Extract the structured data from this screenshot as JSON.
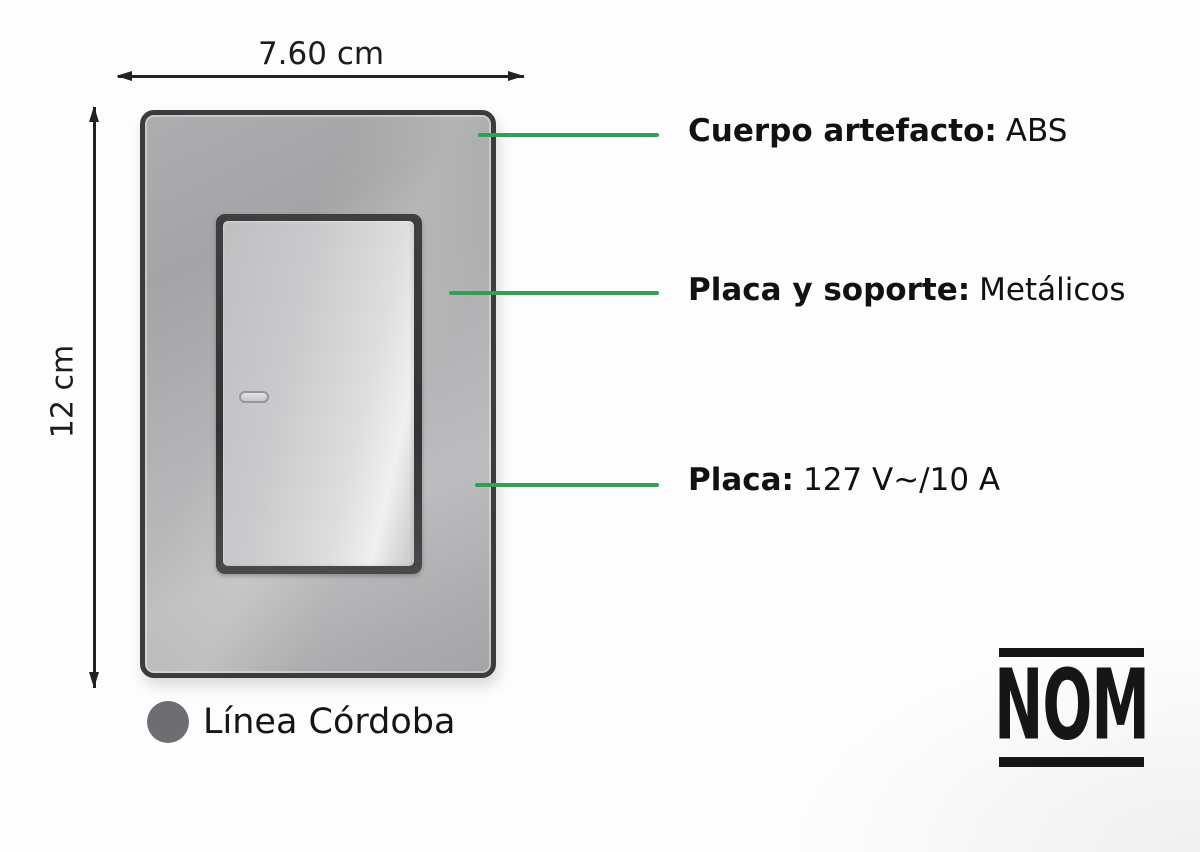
{
  "dimensions": {
    "width_label": "7.60 cm",
    "height_label": "12 cm"
  },
  "callouts": [
    {
      "bold": "Cuerpo artefacto:",
      "value": "ABS"
    },
    {
      "bold": "Placa y soporte:",
      "value": "Metálicos"
    },
    {
      "bold": "Placa:",
      "value": "127 V~/10 A"
    }
  ],
  "legend": {
    "label": "Línea Córdoba"
  },
  "certification": {
    "label": "NOM"
  },
  "colors": {
    "callout_green": "#31a055",
    "legend_circle_gray": "#6e6e72",
    "dimension_line": "#222222",
    "plate_gray": "#ababad",
    "frame_dark": "#3c3c3e"
  }
}
